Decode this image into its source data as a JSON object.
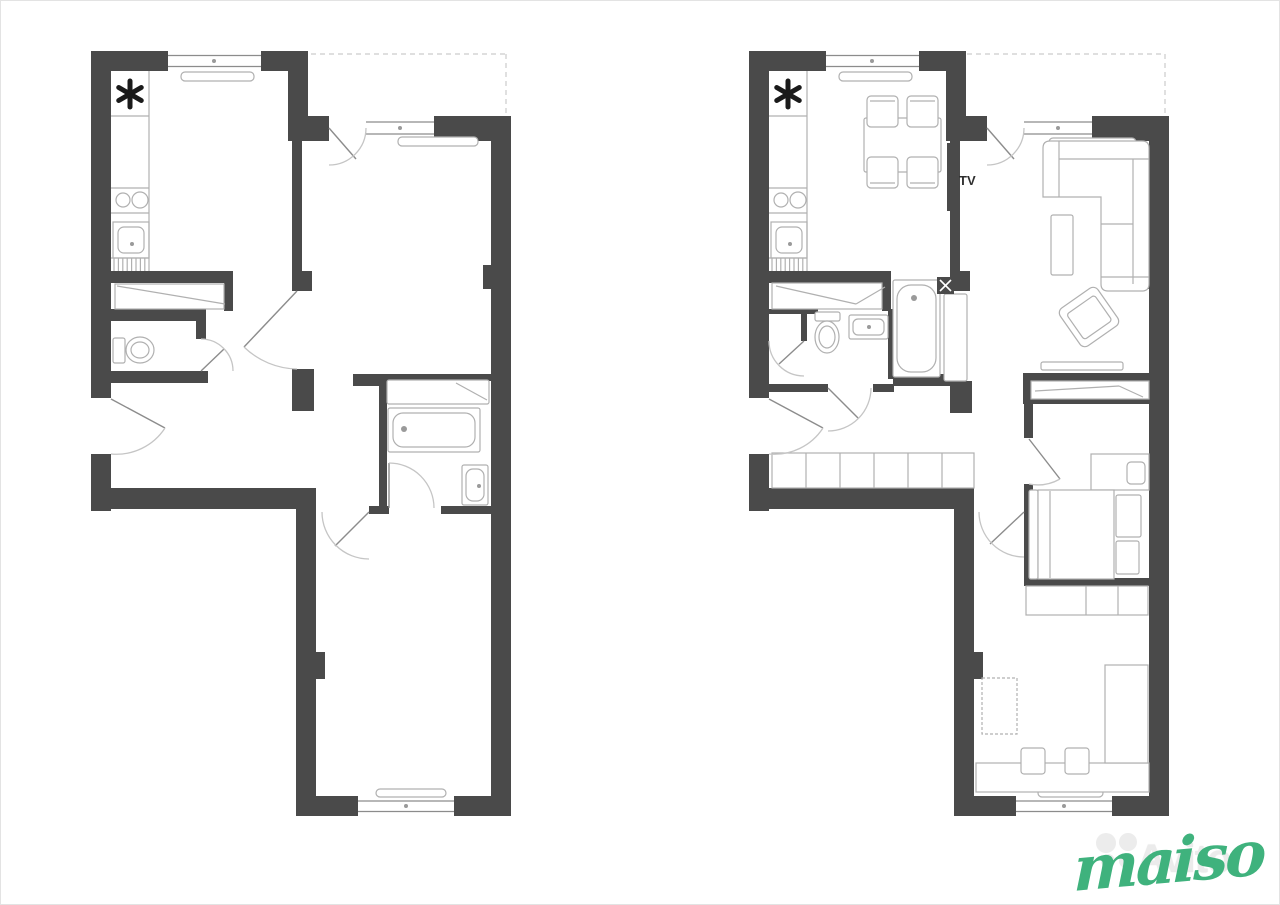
{
  "colors": {
    "wall": "#4a4a4a",
    "furniture": "#b0b0b0",
    "fixture": "#9a9a9a",
    "window_line": "#8c8c8c",
    "door_arc": "#c5c5c5",
    "door_leaf": "#8c8c8c",
    "dashed": "#cccccc",
    "symbol": "#1a1a1a",
    "tv_text": "#2f2f2f",
    "brand_gray": "#ebebeb",
    "brand_green": "#3fb27d",
    "canvas_border": "#e3e3e3"
  },
  "watermark": {
    "brand": "Avito",
    "script": "maiso"
  },
  "icons": {
    "vent_symbol": "six-spoke-asterisk-icon",
    "watermark_logo": "avito-dots-icon"
  },
  "plans": {
    "before": {
      "description": "empty floor plan with kitchen, wc, bathroom, two rooms, hall",
      "dashes": [
        "M310,53 H505",
        "M505,53 V112"
      ],
      "walls": [
        [
          90,
          50,
          77,
          20
        ],
        [
          260,
          50,
          47,
          20
        ],
        [
          90,
          50,
          20,
          347
        ],
        [
          90,
          453,
          20,
          57
        ],
        [
          287,
          70,
          20,
          70
        ],
        [
          287,
          115,
          41,
          25
        ],
        [
          433,
          115,
          77,
          25
        ],
        [
          490,
          140,
          20,
          675
        ],
        [
          90,
          487,
          208,
          21
        ],
        [
          295,
          487,
          20,
          328
        ],
        [
          295,
          795,
          62,
          20
        ],
        [
          453,
          795,
          57,
          20
        ],
        [
          110,
          270,
          122,
          12
        ],
        [
          223,
          270,
          9,
          40
        ],
        [
          110,
          308,
          95,
          12
        ],
        [
          195,
          308,
          10,
          30
        ],
        [
          110,
          370,
          97,
          12
        ],
        [
          291,
          140,
          10,
          132
        ],
        [
          291,
          270,
          20,
          20
        ],
        [
          291,
          368,
          22,
          42
        ],
        [
          352,
          373,
          138,
          7
        ],
        [
          352,
          373,
          30,
          12
        ],
        [
          378,
          378,
          8,
          127
        ],
        [
          368,
          505,
          20,
          8
        ],
        [
          440,
          505,
          50,
          8
        ],
        [
          315,
          651,
          9,
          27
        ],
        [
          482,
          264,
          8,
          24
        ]
      ],
      "outlines": [
        [
          180,
          71,
          73,
          9,
          4
        ],
        [
          397,
          136,
          80,
          9,
          4
        ],
        [
          375,
          788,
          70,
          8,
          4
        ],
        [
          112,
          221,
          36,
          36,
          0
        ],
        [
          117,
          226,
          26,
          26,
          6
        ],
        [
          114,
          283,
          109,
          25,
          0
        ],
        [
          112,
          337,
          12,
          25,
          2
        ],
        [
          387,
          407,
          92,
          44,
          2
        ],
        [
          392,
          412,
          82,
          34,
          10
        ],
        [
          386,
          379,
          102,
          24,
          2
        ],
        [
          461,
          464,
          26,
          40,
          2
        ],
        [
          465,
          468,
          18,
          32,
          7
        ]
      ],
      "furnpaths": [],
      "lines": [
        [
          148,
          70,
          148,
          270
        ],
        [
          110,
          115,
          148,
          115
        ],
        [
          110,
          187,
          148,
          187
        ],
        [
          110,
          212,
          148,
          212
        ],
        [
          110,
          257,
          148,
          257
        ],
        [
          116,
          285,
          224,
          303
        ],
        [
          455,
          382,
          486,
          399
        ]
      ],
      "hatch": [
        [
          113,
          257,
          33,
          13,
          4.4
        ]
      ],
      "circles": [
        [
          122,
          199,
          7
        ],
        [
          139,
          199,
          8
        ]
      ],
      "ellipses": [
        [
          139,
          349,
          14,
          13
        ],
        [
          139,
          349,
          9,
          8
        ]
      ],
      "wlines": [
        [
          167,
          54.5,
          260,
          54.5
        ],
        [
          167,
          65.5,
          260,
          65.5
        ],
        [
          365,
          121,
          433,
          121
        ],
        [
          365,
          133,
          433,
          133
        ],
        [
          357,
          800,
          453,
          800
        ],
        [
          357,
          810.5,
          453,
          810.5
        ]
      ],
      "dots": [
        [
          131,
          243,
          2
        ],
        [
          403,
          428,
          3
        ],
        [
          478,
          485,
          2
        ],
        [
          213,
          60,
          2
        ],
        [
          399,
          127,
          2
        ],
        [
          405,
          805,
          2
        ]
      ],
      "darkrects": [],
      "whitelines": [],
      "dashedrects": [],
      "leafs": [
        [
          110,
          398,
          164,
          427
        ],
        [
          328,
          127,
          355,
          158
        ],
        [
          296,
          290,
          243,
          346
        ],
        [
          200,
          370,
          223,
          348
        ],
        [
          368,
          511,
          334,
          545
        ],
        [
          388,
          507,
          388,
          462
        ]
      ],
      "paths": [
        "M164,427 A58 58 0 0 1 110,453",
        "M365,127 A37 37 0 0 1 328,164",
        "M296,368 A78 78 0 0 1 243,346",
        "M200,338 A32 32 0 0 1 232,370",
        "M321,511 A47 47 0 0 0 368,558",
        "M388,462 A45 45 0 0 1 433,507"
      ],
      "stars": [
        [
          129,
          93,
          13
        ]
      ],
      "rotgroups": [],
      "texts": []
    },
    "after": {
      "description": "same apartment furnished: kitchen-dining, living room with TV and sofa, bathroom, bedroom, study",
      "dashes": [
        "M966,53 H1164",
        "M1164,53 V112"
      ],
      "walls": [
        [
          748,
          50,
          77,
          20
        ],
        [
          918,
          50,
          47,
          20
        ],
        [
          748,
          50,
          20,
          347
        ],
        [
          748,
          453,
          20,
          57
        ],
        [
          945,
          70,
          20,
          70
        ],
        [
          945,
          115,
          41,
          25
        ],
        [
          1091,
          115,
          77,
          25
        ],
        [
          1148,
          140,
          20,
          675
        ],
        [
          748,
          487,
          208,
          21
        ],
        [
          953,
          487,
          20,
          328
        ],
        [
          953,
          795,
          62,
          20
        ],
        [
          1111,
          795,
          57,
          20
        ],
        [
          768,
          270,
          122,
          12
        ],
        [
          881,
          270,
          9,
          40
        ],
        [
          768,
          308,
          49,
          5
        ],
        [
          800,
          311,
          6,
          29
        ],
        [
          768,
          383,
          59,
          8
        ],
        [
          872,
          383,
          21,
          8
        ],
        [
          892,
          373,
          57,
          12
        ],
        [
          887,
          308,
          6,
          70
        ],
        [
          949,
          140,
          10,
          132
        ],
        [
          949,
          270,
          20,
          20
        ],
        [
          949,
          380,
          22,
          32
        ],
        [
          973,
          651,
          9,
          27
        ],
        [
          1140,
          264,
          8,
          24
        ],
        [
          1022,
          372,
          126,
          8
        ],
        [
          1022,
          372,
          8,
          31
        ],
        [
          1023,
          397,
          125,
          6
        ],
        [
          1023,
          403,
          9,
          34
        ],
        [
          1023,
          483,
          9,
          94
        ],
        [
          1023,
          577,
          125,
          8
        ]
      ],
      "outlines": [
        [
          838,
          71,
          73,
          9,
          4
        ],
        [
          1048,
          137,
          87,
          9,
          4
        ],
        [
          1037,
          788,
          65,
          8,
          4
        ],
        [
          770,
          221,
          36,
          36,
          0
        ],
        [
          775,
          226,
          26,
          26,
          6
        ],
        [
          771,
          282,
          110,
          26,
          0
        ],
        [
          814,
          311,
          25,
          9,
          2
        ],
        [
          848,
          314,
          39,
          24,
          2
        ],
        [
          852,
          318,
          31,
          16,
          5
        ],
        [
          892,
          279,
          47,
          97,
          2
        ],
        [
          896,
          284,
          39,
          87,
          14
        ],
        [
          943,
          293,
          23,
          87,
          2
        ],
        [
          771,
          452,
          202,
          35,
          0
        ],
        [
          863,
          117,
          77,
          54,
          2
        ],
        [
          866,
          95,
          31,
          31,
          4
        ],
        [
          906,
          95,
          31,
          31,
          4
        ],
        [
          866,
          156,
          31,
          31,
          4
        ],
        [
          906,
          156,
          31,
          31,
          4
        ],
        [
          1050,
          214,
          22,
          60,
          2
        ],
        [
          1040,
          361,
          82,
          8,
          2
        ],
        [
          1030,
          380,
          118,
          18,
          0
        ],
        [
          1090,
          453,
          58,
          36,
          0
        ],
        [
          1126,
          461,
          18,
          22,
          4
        ],
        [
          1028,
          489,
          9,
          89,
          2
        ],
        [
          1037,
          489,
          76,
          89,
          0
        ],
        [
          1115,
          494,
          25,
          42,
          2
        ],
        [
          1115,
          540,
          23,
          33,
          2
        ],
        [
          1025,
          585,
          122,
          29,
          0
        ],
        [
          975,
          762,
          173,
          29,
          0
        ],
        [
          1104,
          664,
          43,
          98,
          0
        ],
        [
          1020,
          747,
          24,
          26,
          3
        ],
        [
          1064,
          747,
          24,
          26,
          3
        ]
      ],
      "furnpaths": [
        "M1042,147 Q1042,140 1049,140 L1141,140 Q1148,140 1148,147 L1148,283 Q1148,290 1141,290 L1107,290 Q1100,290 1100,283 L1100,196 L1042,196 Z"
      ],
      "lines": [
        [
          806,
          70,
          806,
          270
        ],
        [
          768,
          115,
          806,
          115
        ],
        [
          768,
          187,
          806,
          187
        ],
        [
          768,
          212,
          806,
          212
        ],
        [
          768,
          257,
          806,
          257
        ],
        [
          775,
          285,
          855,
          303
        ],
        [
          855,
          303,
          884,
          286
        ],
        [
          805,
          452,
          805,
          487
        ],
        [
          839,
          452,
          839,
          487
        ],
        [
          873,
          452,
          873,
          487
        ],
        [
          907,
          452,
          907,
          487
        ],
        [
          941,
          452,
          941,
          487
        ],
        [
          869,
          100,
          894,
          100
        ],
        [
          909,
          100,
          934,
          100
        ],
        [
          869,
          182,
          894,
          182
        ],
        [
          909,
          182,
          934,
          182
        ],
        [
          1034,
          390,
          1118,
          385
        ],
        [
          1118,
          385,
          1142,
          396
        ],
        [
          1049,
          490,
          1049,
          577
        ],
        [
          1085,
          585,
          1085,
          614
        ],
        [
          1117,
          585,
          1117,
          614
        ],
        [
          1058,
          140,
          1058,
          196
        ],
        [
          1058,
          158,
          1148,
          158
        ],
        [
          1132,
          158,
          1132,
          283
        ],
        [
          1100,
          276,
          1148,
          276
        ],
        [
          1100,
          223,
          1132,
          223
        ]
      ],
      "hatch": [
        [
          771,
          257,
          33,
          13,
          4.4
        ]
      ],
      "circles": [
        [
          780,
          199,
          7
        ],
        [
          797,
          199,
          8
        ]
      ],
      "ellipses": [
        [
          826,
          336,
          12,
          16
        ],
        [
          826,
          336,
          8,
          11
        ]
      ],
      "wlines": [
        [
          825,
          54.5,
          918,
          54.5
        ],
        [
          825,
          65.5,
          918,
          65.5
        ],
        [
          1023,
          121,
          1091,
          121
        ],
        [
          1023,
          133,
          1091,
          133
        ],
        [
          1015,
          800,
          1111,
          800
        ],
        [
          1015,
          810.5,
          1111,
          810.5
        ]
      ],
      "dots": [
        [
          789,
          243,
          2
        ],
        [
          868,
          326,
          2
        ],
        [
          913,
          297,
          3
        ],
        [
          871,
          60,
          2
        ],
        [
          1057,
          127,
          2
        ],
        [
          1063,
          805,
          2
        ]
      ],
      "darkrects": [
        [
          946,
          142,
          8,
          68
        ],
        [
          936,
          276,
          17,
          17
        ]
      ],
      "whitelines": [
        [
          939,
          279,
          950,
          290
        ],
        [
          950,
          279,
          939,
          290
        ]
      ],
      "dashedrects": [
        [
          981,
          677,
          35,
          56
        ]
      ],
      "leafs": [
        [
          768,
          398,
          822,
          427
        ],
        [
          986,
          127,
          1013,
          158
        ],
        [
          827,
          387,
          857,
          417
        ],
        [
          803,
          340,
          778,
          363
        ],
        [
          1023,
          511,
          989,
          543
        ],
        [
          1028,
          438,
          1059,
          478
        ]
      ],
      "paths": [
        "M822,427 A58 58 0 0 1 768,453",
        "M1023,127 A37 37 0 0 1 986,164",
        "M870,387 A43 43 0 0 1 827,430",
        "M768,340 A35 35 0 0 0 803,375",
        "M978,511 A45 45 0 0 0 1023,556",
        "M1059,478 A45 45 0 0 1 1028,483"
      ],
      "stars": [
        [
          787,
          93,
          13
        ]
      ],
      "rotgroups": [
        [
          1088,
          316,
          -35,
          [
            1065,
            293,
            46,
            46,
            6
          ],
          [
            1071,
            301,
            34,
            31,
            3
          ]
        ]
      ],
      "texts": [
        [
          958,
          184,
          "TV",
          13,
          "600",
          "start"
        ]
      ]
    }
  }
}
